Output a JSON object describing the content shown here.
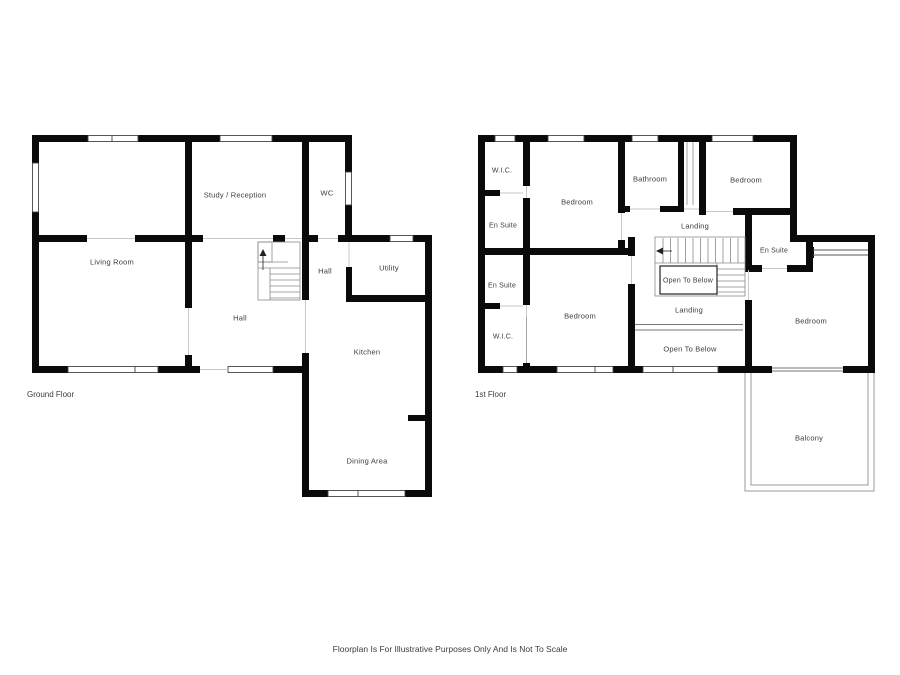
{
  "disclaimer": "Floorplan Is For Illustrative Purposes Only And Is Not To Scale",
  "colors": {
    "wall": "#0a0a0a",
    "background": "#ffffff",
    "text": "#3c3c3c"
  },
  "ground_floor": {
    "name": "Ground Floor",
    "rooms": [
      {
        "label": "Study / Reception"
      },
      {
        "label": "WC"
      },
      {
        "label": "Living Room"
      },
      {
        "label": "Hall"
      },
      {
        "label": "Utility"
      },
      {
        "label": "Hall"
      },
      {
        "label": "Kitchen"
      },
      {
        "label": "Dining Area"
      }
    ]
  },
  "first_floor": {
    "name": "1st Floor",
    "rooms": [
      {
        "label": "W.I.C."
      },
      {
        "label": "Bedroom"
      },
      {
        "label": "Bathroom"
      },
      {
        "label": "Bedroom"
      },
      {
        "label": "En Suite"
      },
      {
        "label": "Landing"
      },
      {
        "label": "En Suite"
      },
      {
        "label": "Open To Below"
      },
      {
        "label": "En Suite"
      },
      {
        "label": "Bedroom"
      },
      {
        "label": "Landing"
      },
      {
        "label": "Bedroom"
      },
      {
        "label": "W.I.C."
      },
      {
        "label": "Open To Below"
      },
      {
        "label": "Balcony"
      }
    ]
  }
}
